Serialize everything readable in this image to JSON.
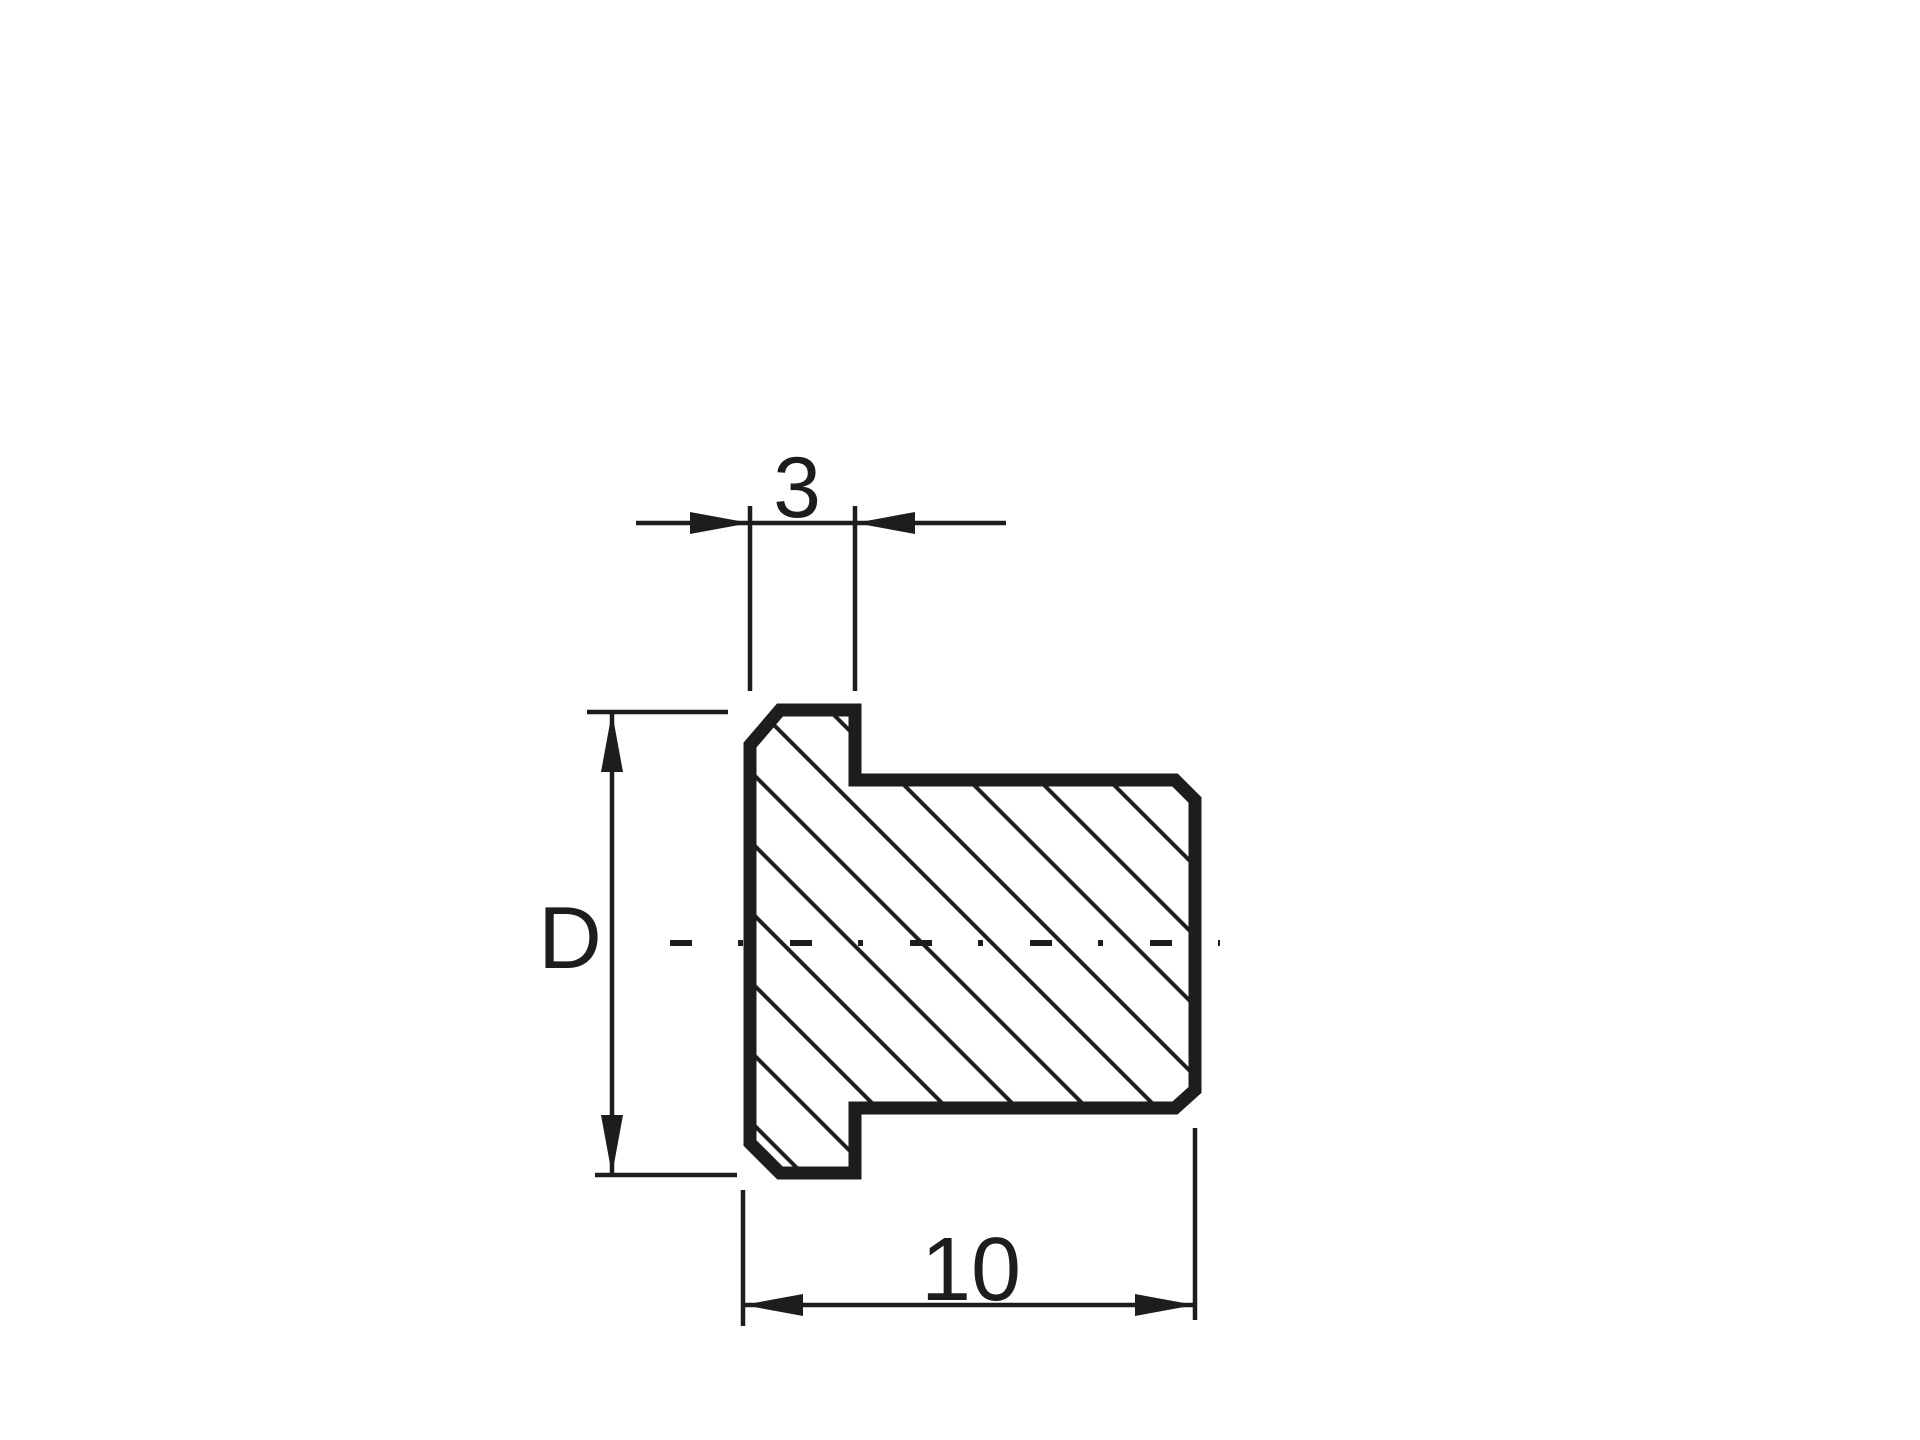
{
  "drawing": {
    "background_color": "#ffffff",
    "ink_color": "#1d1d1b",
    "dimensions": {
      "flange_thickness": {
        "label": "3"
      },
      "diameter": {
        "label": "D"
      },
      "overall_length": {
        "label": "10"
      }
    }
  }
}
